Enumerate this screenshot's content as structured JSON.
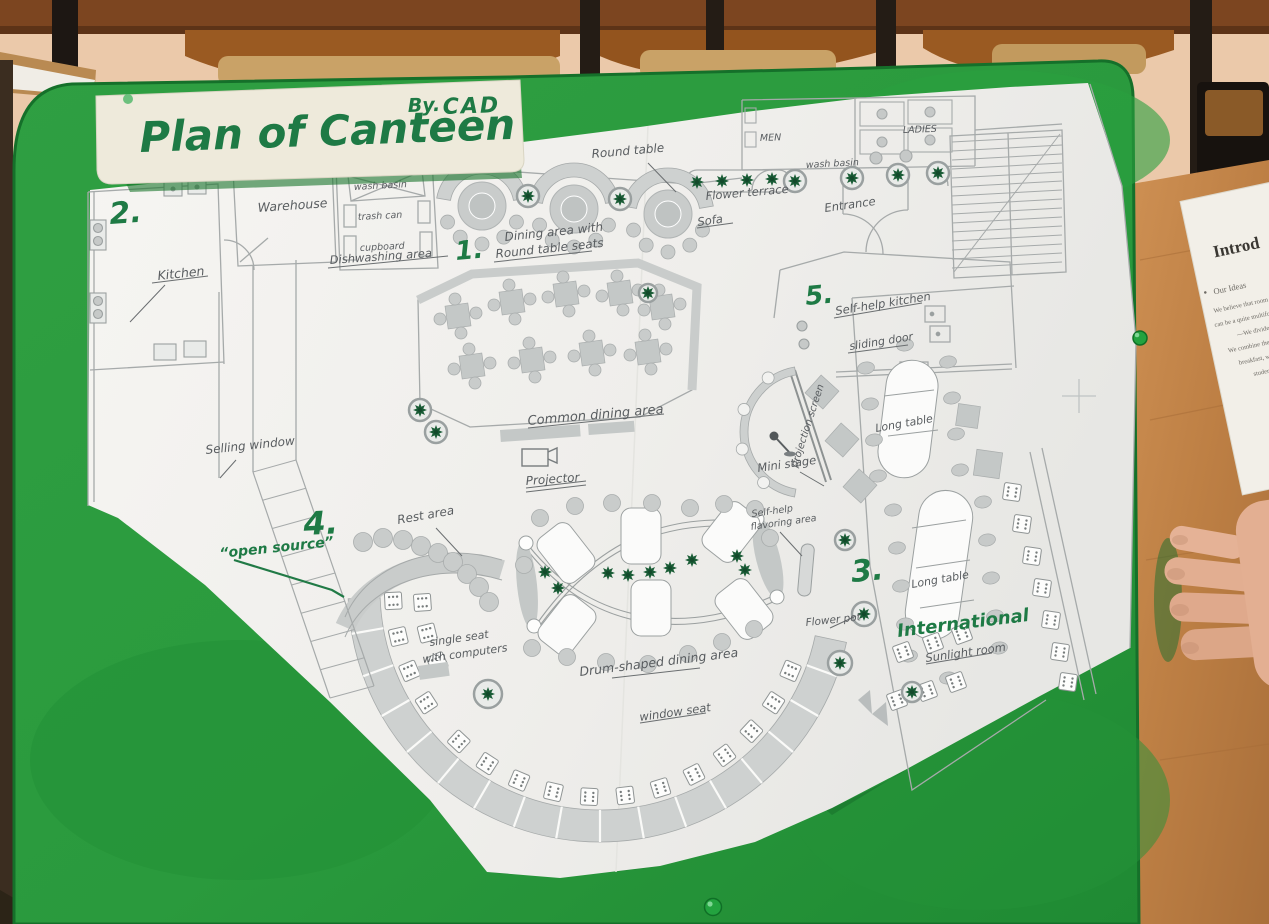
{
  "banner": {
    "title": "Plan of Canteen",
    "byline_by": "By.",
    "byline_name": "CAD"
  },
  "areas": {
    "n1": "1.",
    "n2": "2.",
    "n3": "3.",
    "n4": "4.",
    "n5": "5.",
    "area1_line1": "Dining area with",
    "area1_line2": "Round table seats",
    "area3_name": "International",
    "area4_name": "Rest area",
    "area5_name": "Self-help kitchen"
  },
  "labels": {
    "round_table": "Round table",
    "warehouse": "Warehouse",
    "wash_basin": "wash basin",
    "trash_can": "trash can",
    "cupboard": "cupboard",
    "dishwashing_area": "Dishwashing area",
    "kitchen": "Kitchen",
    "flower_terrace": "Flower terrace",
    "sofa": "Sofa",
    "entrance": "Entrance",
    "men": "MEN",
    "ladies": "LADIES",
    "wash_basin_restroom": "wash basin",
    "sliding_door": "sliding door",
    "common_dining_area": "Common dining area",
    "projector": "Projector",
    "projection_screen": "projection screen",
    "mini_stage": "Mini stage",
    "long_table_upper": "Long table",
    "long_table_lower": "Long table",
    "selling_window": "Selling window",
    "open_source": "“open source”",
    "single_seat_line1": "single seat",
    "single_seat_line2": "with computers",
    "flavoring_line1": "Self-help",
    "flavoring_line2": "flavoring area",
    "drum_dining_area": "Drum-shaped dining area",
    "window_seat": "window seat",
    "flower_pot": "Flower pot",
    "sunlight_room": "Sunlight room"
  },
  "side_paper": {
    "title": "Introd",
    "bullet_icon": "●",
    "bullet": "Our Ideas",
    "lines": [
      "We believe that room to flexib",
      "can be a quite multifunctio",
      "—We divide the wh",
      "We combine the",
      "breakfast, whi",
      "students'"
    ]
  },
  "colors": {
    "board_green": "#2E9C40",
    "marker_green": "#1E7A45",
    "pencil_gray": "#595D60",
    "plan_gray": "#AFB4B3",
    "desk_wood": "#C08448",
    "wall_peach": "#ECCBAC",
    "skin": "#E2B095"
  }
}
